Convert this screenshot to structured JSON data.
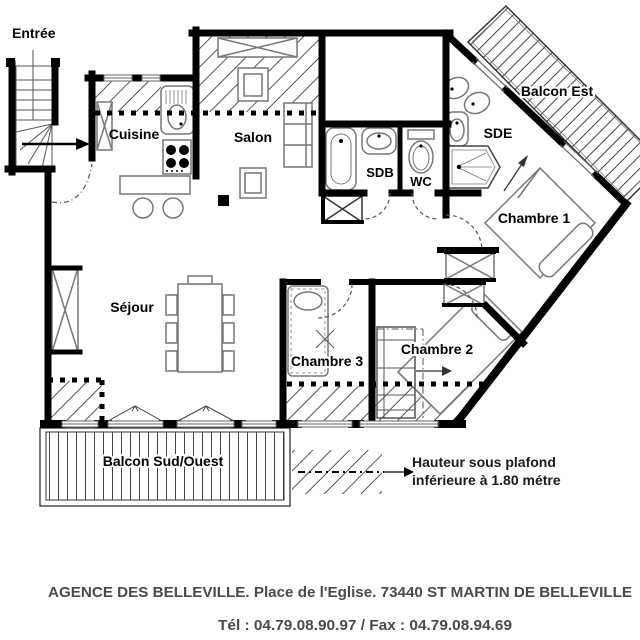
{
  "plan": {
    "rooms": {
      "entree": "Entrée",
      "cuisine": "Cuisine",
      "salon": "Salon",
      "sejour": "Séjour",
      "sdb": "SDB",
      "wc": "WC",
      "sde": "SDE",
      "chambre1": "Chambre 1",
      "chambre2": "Chambre 2",
      "chambre3": "Chambre 3",
      "balcon_est": "Balcon Est",
      "balcon_sud_ouest": "Balcon Sud/Ouest"
    },
    "legend": {
      "line1": "Hauteur sous plafond",
      "line2": "inférieure à 1.80 métre"
    },
    "colors": {
      "wall": "#000000",
      "furniture": "#777777",
      "hatch": "#555555",
      "background": "#ffffff",
      "footer_text": "#4a4a4a"
    }
  },
  "footer": {
    "line1": "AGENCE DES BELLEVILLE. Place de l'Eglise. 73440 ST MARTIN DE BELLEVILLE",
    "line2": "Tél : 04.79.08.90.97 / Fax : 04.79.08.94.69"
  }
}
